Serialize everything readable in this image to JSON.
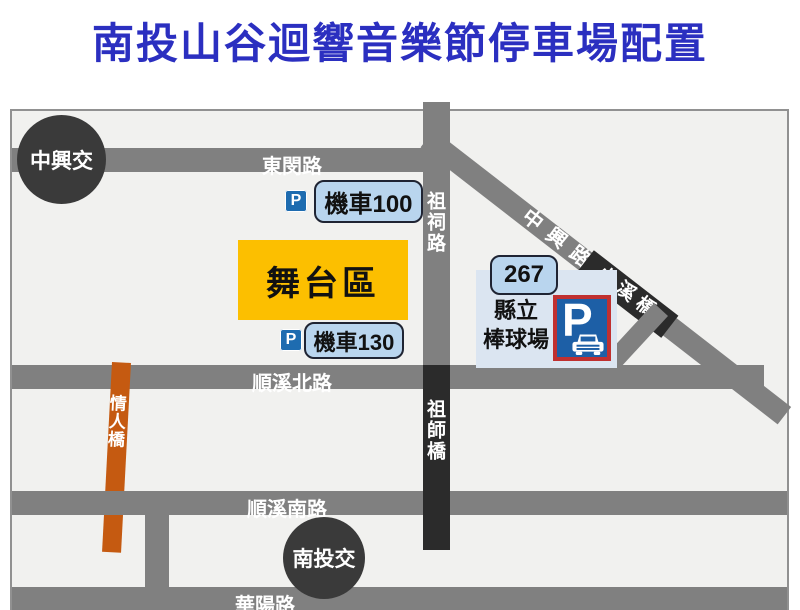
{
  "title": "南投山谷迴響音樂節停車場配置",
  "colors": {
    "title_blue": "#2b2fc0",
    "road_gray": "#808080",
    "road_black": "#2b2b2b",
    "bridge_orange": "#c55a11",
    "stage_yellow": "#fcbf00",
    "label_blue": "#b9d5ee",
    "panel_blue": "#dbe5f1",
    "parking_blue": "#1d5fa6",
    "parking_red_border": "#c03030"
  },
  "map": {
    "interchanges": {
      "zhongxing": "中興交",
      "nantou": "南投交"
    },
    "roads": {
      "dongmin": "東閔路",
      "zuci": "祖祠路",
      "zhongxing_rd": "中興路",
      "xiaoxi_bridge": "小溪橋",
      "shunxi_north": "順溪北路",
      "zushi_bridge": "祖師橋",
      "qingren_bridge": "情人橋",
      "shunxi_south": "順溪南路",
      "huayang": "華陽路"
    },
    "labels": {
      "stage": "舞台區",
      "moto100": "機車100",
      "moto130": "機車130",
      "route267": "267",
      "stadium_line1": "縣立",
      "stadium_line2": "棒球場",
      "parking_p": "P"
    }
  }
}
